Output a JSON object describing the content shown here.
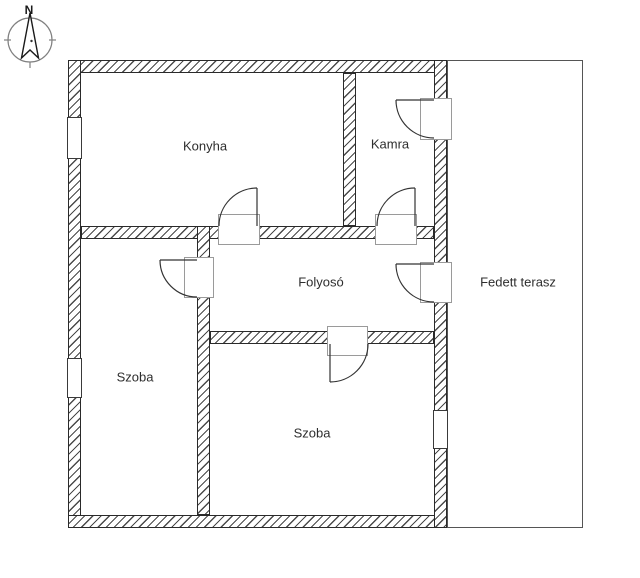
{
  "compass": {
    "north_label": "N"
  },
  "rooms": [
    {
      "id": "konyha",
      "label": "Konyha"
    },
    {
      "id": "kamra",
      "label": "Kamra"
    },
    {
      "id": "folyoso",
      "label": "Folyosó"
    },
    {
      "id": "szoba-left",
      "label": "Szoba"
    },
    {
      "id": "szoba-bottom",
      "label": "Szoba"
    },
    {
      "id": "terasz",
      "label": "Fedett terasz"
    }
  ],
  "colors": {
    "background": "#ffffff",
    "wall_outline": "#2a2a2a",
    "wall_hatch": "#4a4a4a",
    "door_frame_line": "#9a9a9a",
    "door_swing_line": "#333333",
    "terrace_outline": "#555555",
    "text": "#2e2e2e"
  }
}
